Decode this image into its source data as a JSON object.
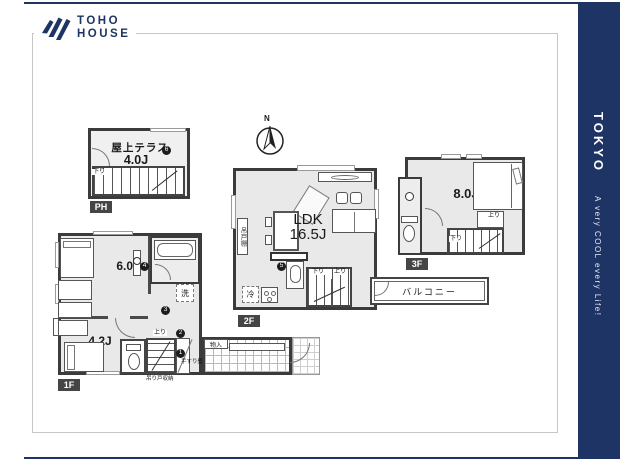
{
  "brand": {
    "line1": "TOHO",
    "line2": "HOUSE"
  },
  "sidebar": {
    "title": "TOKYO",
    "tagline": "A very COOL every Life!"
  },
  "compass": {
    "north": "N"
  },
  "colors": {
    "navy": "#1e3464",
    "wall": "#3b3b3b",
    "room_fill": "#e9e9e9"
  },
  "floors": {
    "ph": {
      "badge": "PH",
      "room_label": "屋上テラス",
      "room_size": "4.0J",
      "marker6": "6",
      "stair_down": "下り"
    },
    "f2": {
      "badge": "2F",
      "room_label": "LDK",
      "room_size": "16.5J",
      "cupboard": "吊戸棚",
      "fridge": "冷",
      "stair_down": "下り",
      "stair_up": "上り",
      "marker5": "5",
      "balcony": "バルコニー"
    },
    "f3": {
      "badge": "3F",
      "room_size": "8.0J",
      "stair_up": "上り",
      "stair_down": "下り"
    },
    "f1": {
      "badge": "1F",
      "room1_size": "6.0J",
      "room2_size": "4.2J",
      "washer": "洗",
      "storage": "物入",
      "stair_up": "上り",
      "marker1": "1",
      "marker2": "2",
      "marker3": "3",
      "marker4": "4",
      "note_handrail": "手すり壁",
      "note_storage": "吊り戸収納"
    }
  }
}
